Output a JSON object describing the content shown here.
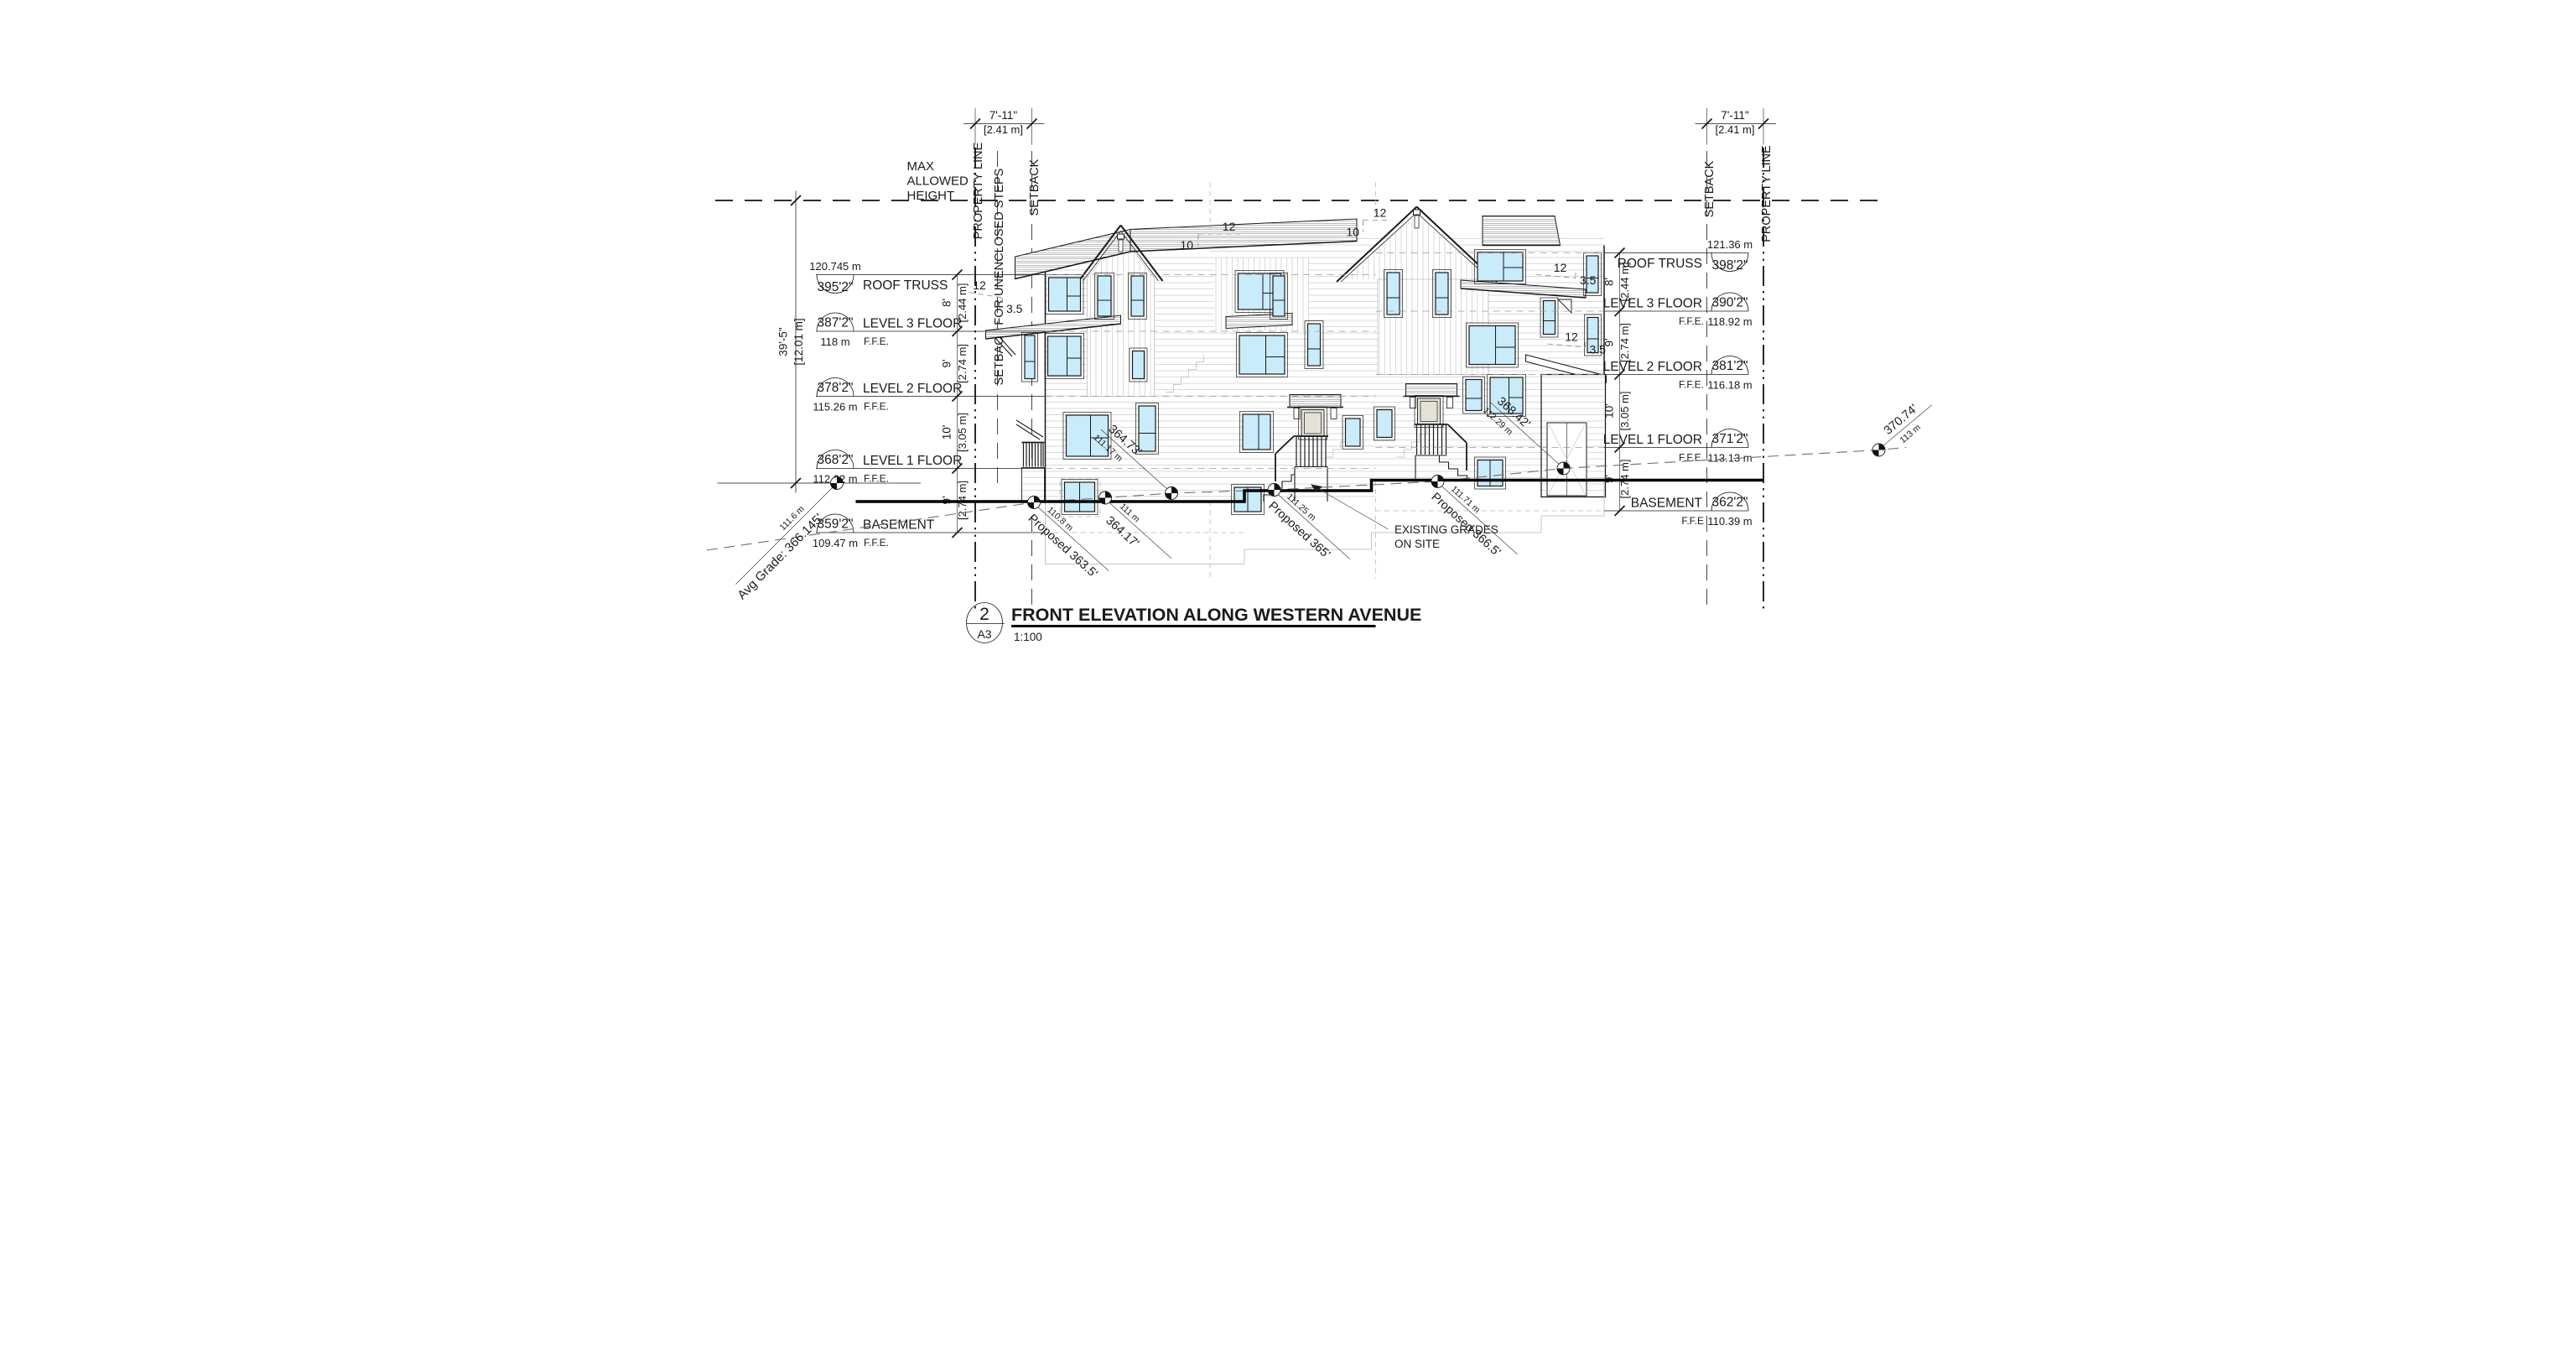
{
  "drawing": {
    "title_block": {
      "detail_number": "2",
      "sheet": "A3",
      "title": "FRONT ELEVATION ALONG WESTERN AVENUE",
      "scale": "1:100"
    },
    "max_height_label": [
      "MAX",
      "ALLOWED",
      "HEIGHT"
    ],
    "overall_height": {
      "ft": "39'-5\"",
      "m": "[12.01 m]"
    },
    "setback_dim": {
      "ft": "7'-11\"",
      "m": "[2.41 m]"
    },
    "boundary_labels": {
      "property_line": "PROPERTY LINE",
      "setback": "SETBACK",
      "steps_setback": "SETBACK FOR UNENCLOSED STEPS"
    },
    "levels_left": [
      {
        "name": "ROOF TRUSS",
        "ft": "395'2\"",
        "m": "120.745 m",
        "ffe": ""
      },
      {
        "name": "LEVEL 3 FLOOR",
        "ft": "387'2\"",
        "m": "118 m",
        "ffe": "F.F.E."
      },
      {
        "name": "LEVEL 2 FLOOR",
        "ft": "378'2\"",
        "m": "115.26 m",
        "ffe": "F.F.E."
      },
      {
        "name": "LEVEL 1 FLOOR",
        "ft": "368'2\"",
        "m": "112.22 m",
        "ffe": "F.F.E."
      },
      {
        "name": "BASEMENT",
        "ft": "359'2\"",
        "m": "109.47 m",
        "ffe": "F.F.E."
      }
    ],
    "levels_right": [
      {
        "name": "ROOF TRUSS",
        "ft": "398'2\"",
        "m": "121.36 m",
        "ffe": ""
      },
      {
        "name": "LEVEL 3 FLOOR",
        "ft": "390'2\"",
        "m": "118.92 m",
        "ffe": "F.F.E."
      },
      {
        "name": "LEVEL 2 FLOOR",
        "ft": "381'2\"",
        "m": "116.18 m",
        "ffe": "F.F.E."
      },
      {
        "name": "LEVEL 1 FLOOR",
        "ft": "371'2\"",
        "m": "113.13 m",
        "ffe": "F.F.E."
      },
      {
        "name": "BASEMENT",
        "ft": "362'2\"",
        "m": "110.39 m",
        "ffe": "F.F.E"
      }
    ],
    "floor_dims": [
      {
        "ft": "8'",
        "m": "[2.44 m]"
      },
      {
        "ft": "9'",
        "m": "[2.74 m]"
      },
      {
        "ft": "10'",
        "m": "[3.05 m]"
      },
      {
        "ft": "9'",
        "m": "[2.74 m]"
      }
    ],
    "roof_slopes": {
      "main_rise": "12",
      "main_run": "10",
      "low_run": "3.5"
    },
    "grade_annotations": {
      "avg_grade": {
        "label": "Avg Grade: 366.145'",
        "metric": "111.6 m"
      },
      "points": [
        {
          "label": "Proposed 363.5'",
          "metric": "110.8 m"
        },
        {
          "label": "364.17'",
          "metric": "111 m"
        },
        {
          "label": "364.73'",
          "metric": "111.17 m"
        },
        {
          "label": "Proposed 365'",
          "metric": "111.25 m"
        },
        {
          "label": "Proposed 366.5'",
          "metric": "111.71 m"
        },
        {
          "label": "368.42'",
          "metric": "112.29 m"
        },
        {
          "label": "370.74'",
          "metric": "113 m"
        }
      ],
      "existing_note": [
        "EXISTING GRADES",
        "ON SITE"
      ]
    },
    "colors": {
      "window_glass": "#c9ebfa",
      "door": "#e4e1d6",
      "line": "#1a1a1a"
    }
  }
}
